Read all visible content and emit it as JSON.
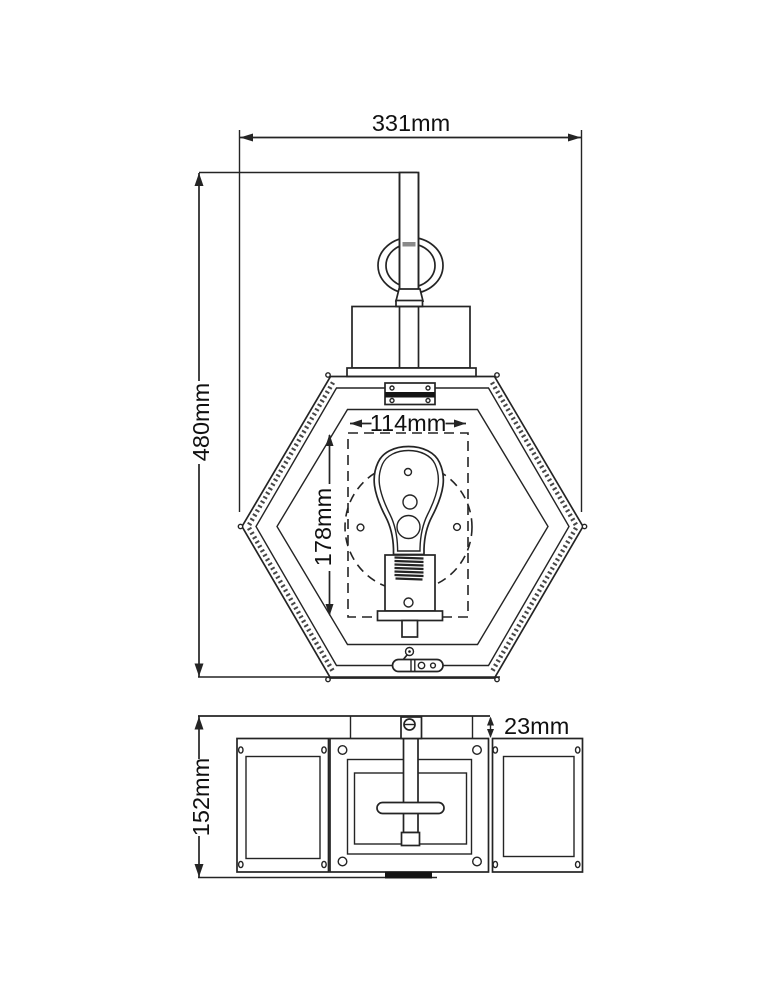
{
  "drawing": {
    "type": "wall-lantern dimension drawing",
    "front_view": {
      "overall_width": "331mm",
      "overall_height": "480mm",
      "bulb_opening_width": "114mm",
      "bulb_opening_height": "178mm"
    },
    "bottom_view": {
      "depth": "152mm",
      "wall_gap": "23mm"
    }
  }
}
